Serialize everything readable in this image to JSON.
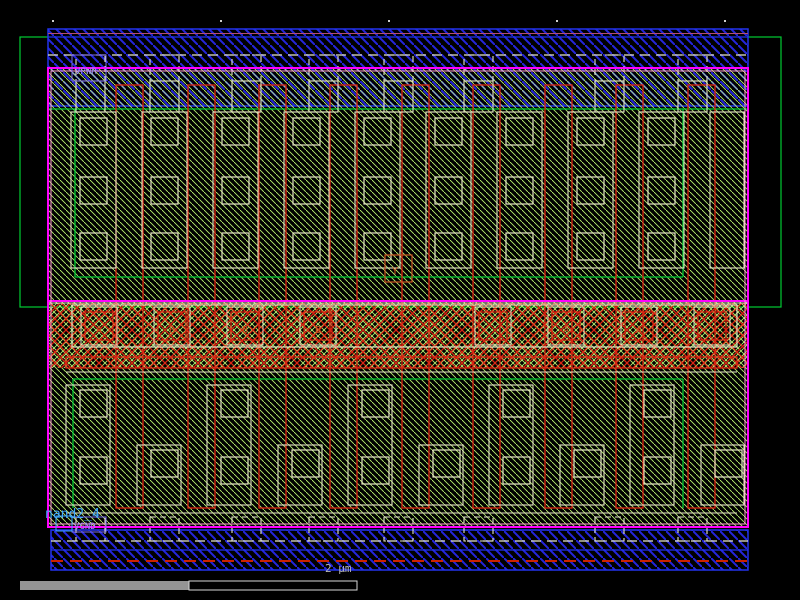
{
  "window": {
    "title": "layout-viewer",
    "background": "#000000"
  },
  "labels": {
    "vpwr": "VPWR",
    "vgnd": "VGND",
    "instance": "nand2_4",
    "scale": "2 µm",
    "output_pin": "Y"
  },
  "pins": {
    "letters": [
      "A",
      "B",
      "B",
      "B",
      "",
      "A",
      "A",
      ""
    ],
    "xs": [
      85,
      158,
      231,
      304,
      479,
      552,
      625,
      698
    ]
  },
  "colors": {
    "met1": "#2525dd",
    "met1_border": "#2233ee",
    "diff_hatch": "#b8ef70",
    "li": "#e9e9c8",
    "poly": "#dd2211",
    "nwell": "#00cc33",
    "boundary": "#ff00ff",
    "boundary_inner": "#ff9ad5",
    "label": "#9b8cff",
    "label_box": "#7d6ef0",
    "instance_text": "#3fa8ff",
    "pin_text": "#cc5522",
    "dash_white": "#e8e8d0",
    "dash_red": "#cc2200",
    "band_accent": "#b34d77",
    "ruler_dot": "#cfcfcf",
    "scalebar_fill": "#949494",
    "scalebar_outline": "#d8d8d8",
    "scale_text": "#b9b9b9"
  },
  "geometry": {
    "canvas": {
      "w": 800,
      "h": 600
    },
    "ruler_dots": {
      "xs": [
        52,
        220,
        388,
        556,
        724
      ],
      "y": 20
    },
    "nwell": [
      20,
      37,
      761,
      270
    ],
    "top_band": [
      48,
      29,
      700,
      77
    ],
    "top_band_accent_y": 33.5,
    "top_band_inner_y": 37,
    "top_dash_y": 55,
    "bottom_band": [
      51,
      530,
      697,
      40
    ],
    "bottom_dash_y": 541,
    "bottom_blue_y": 550,
    "bottom_red_dash_y": 561,
    "cell": [
      48,
      68,
      700,
      459
    ],
    "mid_band": [
      48,
      303,
      700,
      65
    ],
    "mid_magenta_y": 301,
    "tab_xs": [
      76,
      150,
      232,
      309,
      384,
      464,
      595,
      678
    ],
    "tab_w": 29,
    "top_tabs": {
      "dash_y1": 55,
      "dash_y2": 81,
      "solid_y1": 81,
      "solid_y2": 112
    },
    "bottom_tabs": {
      "dash_y1": 517,
      "dash_y2": 541
    },
    "green_top": {
      "y1": 109,
      "x1": 75,
      "x2": 683,
      "y2": 277
    },
    "green_bot": {
      "y1": 379,
      "x1": 73,
      "x2": 683,
      "y2": 508
    },
    "poly": {
      "xs": [
        116,
        188,
        259,
        330,
        402,
        473,
        545,
        616,
        688
      ],
      "w": 27,
      "y1": 85,
      "y2": 508
    },
    "poly_strap": [
      66,
      357,
      671,
      11
    ],
    "top_cols": {
      "xs": [
        80,
        151,
        222,
        293,
        364,
        435,
        506,
        577,
        648,
        719
      ],
      "sq": 27,
      "sq_ys": [
        118,
        177,
        233
      ],
      "outer_dx": -9,
      "outer_w": 45,
      "outer_y1": 112,
      "outer_y2": 268,
      "max_x": 744
    },
    "bot_groups": {
      "count": 5,
      "step": 141,
      "tall": {
        "x": 66,
        "w": 44,
        "y1": 385,
        "y2": 505,
        "sq_x": 80,
        "sq_y1": 390,
        "sq_y2": 457
      },
      "low": {
        "x": 137,
        "w": 44,
        "y1": 445,
        "y2": 505,
        "sq_x": 151,
        "sq_y": 450
      },
      "sq": 27,
      "max_x": 744
    },
    "mid_outer": [
      72,
      305,
      665,
      42
    ],
    "pin_boxes": {
      "pale_dx": -4,
      "pale_y": 307,
      "pale_w": 36,
      "pale_h": 38,
      "red_y": 312,
      "red_s": 28,
      "text_dx": 14,
      "text_y": 333
    },
    "pale_lines": [
      [
        66,
        372,
        737,
        372
      ],
      [
        66,
        513,
        737,
        513
      ],
      [
        48,
        303,
        748,
        303
      ]
    ],
    "ypin_box": [
      385,
      255,
      27,
      27
    ],
    "vpwr_box": [
      72,
      55,
      34,
      26
    ],
    "vgnd_box": [
      72,
      517,
      34,
      15
    ],
    "origin_box": [
      56,
      516,
      16,
      15
    ],
    "label_pos": {
      "vpwr": [
        75,
        74
      ],
      "vgnd": [
        74,
        529
      ],
      "instance": [
        45,
        518
      ],
      "ypin": [
        392,
        274
      ]
    },
    "scalebar": {
      "fill": [
        20,
        581,
        169,
        9
      ],
      "outline": [
        189,
        581,
        168,
        9
      ],
      "text_x": 325,
      "text_y": 572
    }
  }
}
